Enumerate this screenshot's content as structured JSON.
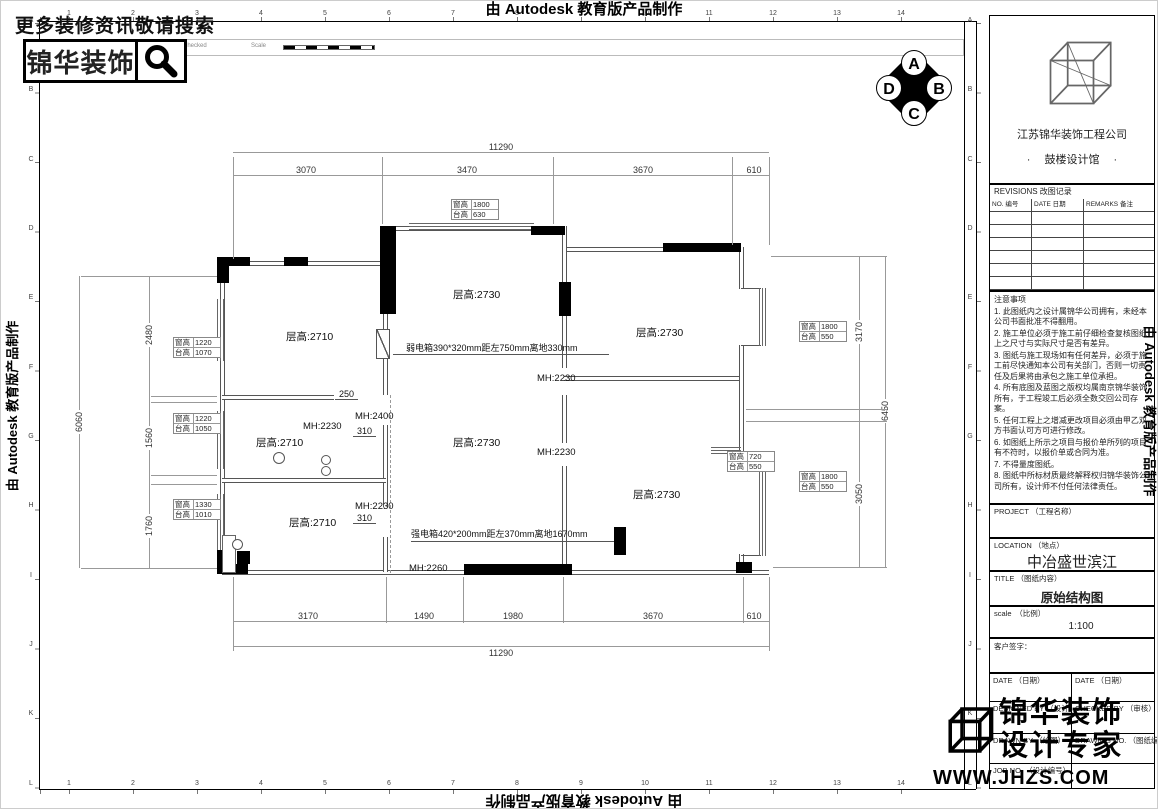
{
  "page": {
    "autodesk": "由 Autodesk 教育版产品制作"
  },
  "topbar": {
    "search_hint": "更多装修资讯敬请搜索",
    "brand": "锦华装饰",
    "header_cells": [
      "Rev No",
      "Revision note",
      "Signature",
      "Checked",
      "Scale"
    ]
  },
  "grid": {
    "cols": [
      "1",
      "2",
      "3",
      "4",
      "5",
      "6",
      "7",
      "8",
      "9",
      "10",
      "11",
      "12",
      "13",
      "14"
    ],
    "rows": [
      "A",
      "B",
      "C",
      "D",
      "E",
      "F",
      "G",
      "H",
      "I",
      "J",
      "K",
      "L"
    ]
  },
  "compass": {
    "top": "A",
    "right": "B",
    "bottom": "C",
    "left": "D"
  },
  "titleblock": {
    "company": "江苏锦华装饰工程公司",
    "office": "·　 鼓楼设计馆 　·",
    "revisions_title": "REVISIONS 改图记录",
    "revisions_cols": [
      "NO. 编号",
      "DATE 日期",
      "REMARKS 备注"
    ],
    "notes_title": "注意事项",
    "notes": [
      "1. 此图纸内之设计属锦华公司拥有，未经本公司书面批准不得翻用。",
      "2. 施工单位必须于施工前仔细检查复核图纸上之尺寸与实际尺寸是否有差异。",
      "3. 图纸与施工现场如有任何差异，必须于施工前尽快通知本公司有关部门，否则一切责任及后果将由承包之施工单位承担。",
      "4. 所有底图及蓝图之版权均属南京锦华装饰所有，于工程竣工后必须全数交回公司存案。",
      "5. 任何工程上之增减更改项目必须由甲乙双方书面认可方可进行修改。",
      "6. 如图纸上所示之项目与报价单所列的项目有不符时，以报价单或合同为准。",
      "7. 不得量度图纸。",
      "8. 图纸中所标材质最终解释权归锦华装饰公司所有，设计师不付任何法律责任。"
    ],
    "project_label": "PROJECT （工程名称）",
    "location_label": "LOCATION （地点）",
    "location_value": "中冶盛世滨江",
    "title_label": "TITLE （图纸内容）",
    "title_value": "原始结构图",
    "scale_label": "scale　（比例）",
    "scale_value": "1:100",
    "client_label": "客户签字：",
    "date_label_1": "DATE （日期）",
    "date_label_2": "DATE （日期）",
    "designed_label": "DESIGNED BY （设计）",
    "checked_label": "CHECKED BY （审核）",
    "drawn_label": "DRAWN BY （绘图）",
    "drawing_no_label": "DRAWING NO. （图纸编号）",
    "job_no_label": "JOB NO. （设计编号）"
  },
  "watermark": {
    "line1": "锦华装饰",
    "line2": "设计专家",
    "url": "WWW.JHZS.COM"
  },
  "plan": {
    "rooms": [
      "层高:2710",
      "层高:2730",
      "层高:2730",
      "层高:2710",
      "层高:2730",
      "层高:2710",
      "层高:2730"
    ],
    "mh": [
      "MH:2230",
      "MH:2400",
      "MH:2230",
      "MH:2230",
      "MH:2230",
      "MH:2260"
    ],
    "small_dims": [
      "250",
      "310",
      "310"
    ],
    "dims_top": {
      "overall": "11290",
      "segs": [
        "3070",
        "3470",
        "3670",
        "610"
      ]
    },
    "dims_bottom": {
      "overall": "11290",
      "segs": [
        "3170",
        "1490",
        "1980",
        "3670",
        "610"
      ]
    },
    "dims_left": {
      "overall": "6060",
      "segs": [
        "2480",
        "1560",
        "1760"
      ]
    },
    "dims_right": {
      "overall": "6450",
      "segs": [
        "3170",
        "3050"
      ]
    },
    "win_tables": [
      {
        "l1": "窗高",
        "v1": "1800",
        "l2": "台高",
        "v2": "630"
      },
      {
        "l1": "窗高",
        "v1": "1220",
        "l2": "台高",
        "v2": "1070"
      },
      {
        "l1": "窗高",
        "v1": "1220",
        "l2": "台高",
        "v2": "1050"
      },
      {
        "l1": "窗高",
        "v1": "1330",
        "l2": "台高",
        "v2": "1010"
      },
      {
        "l1": "窗高",
        "v1": "1800",
        "l2": "台高",
        "v2": "550"
      },
      {
        "l1": "窗高",
        "v1": "720",
        "l2": "台高",
        "v2": "550"
      },
      {
        "l1": "窗高",
        "v1": "1800",
        "l2": "台高",
        "v2": "550"
      }
    ],
    "weak_box": "弱电箱390*320mm距左750mm离地330mm",
    "strong_box": "强电箱420*200mm距左370mm离地1670mm"
  }
}
